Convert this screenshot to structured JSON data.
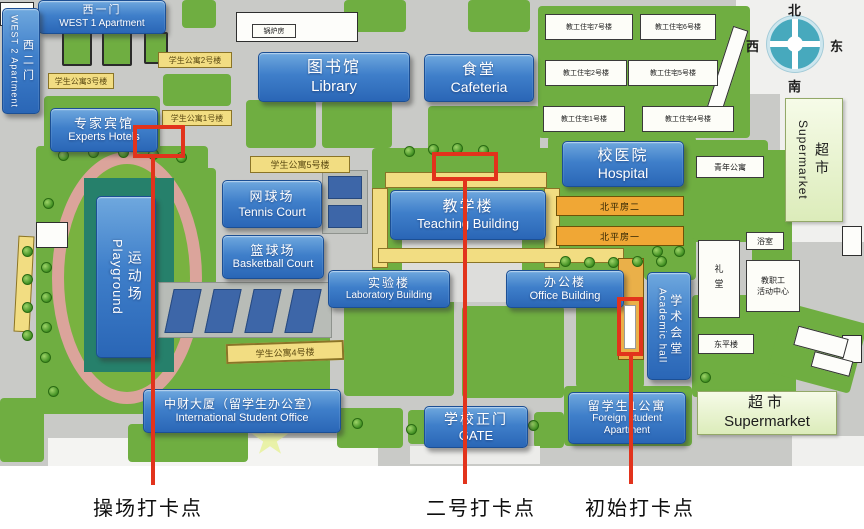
{
  "colors": {
    "map_gray": "#c9cac7",
    "lawn_green": "#6fae41",
    "annotation_red": "#e2331c",
    "label_blue": "#3f7fca",
    "apartment_yellow": "#f2dd82",
    "bungalow_orange": "#f0a735"
  },
  "compass": {
    "north": "北",
    "west": "西",
    "east": "东",
    "south": "南"
  },
  "labels": {
    "west1": {
      "zh": "西一门",
      "en": "WEST 1 Apartment"
    },
    "west2": {
      "zh": "西二门",
      "en": "WEST 2 Apartment"
    },
    "experts": {
      "zh": "专家宾馆",
      "en": "Experts Hotels"
    },
    "library": {
      "zh": "图书馆",
      "en": "Library"
    },
    "cafeteria": {
      "zh": "食堂",
      "en": "Cafeteria"
    },
    "hospital": {
      "zh": "校医院",
      "en": "Hospital"
    },
    "tennis": {
      "zh": "网球场",
      "en": "Tennis Court"
    },
    "basketball": {
      "zh": "篮球场",
      "en": "Basketball Court"
    },
    "teaching": {
      "zh": "教学楼",
      "en": "Teaching Building"
    },
    "laboratory": {
      "zh": "实验楼",
      "en": "Laboratory Building"
    },
    "office": {
      "zh": "办公楼",
      "en": "Office Building"
    },
    "academic": {
      "zh": "学术会堂",
      "en": "Academic hall"
    },
    "playground": {
      "zh": "运动场",
      "en": "Playground"
    },
    "intl_office": {
      "zh": "中财大厦（留学生办公室）",
      "en": "International Student Office"
    },
    "gate": {
      "zh": "学校正门",
      "en": "GATE"
    },
    "foreign_apt": {
      "zh": "留学生1公寓",
      "en1": "Foreign student",
      "en2": "Apartment"
    }
  },
  "small_labels": {
    "stu_apt_1": "学生公寓1号楼",
    "stu_apt_2": "学生公寓2号楼",
    "stu_apt_3": "学生公寓3号楼",
    "stu_apt_4": "学生公寓4号楼",
    "stu_apt_5": "学生公寓5号楼",
    "staff_1": "教工住宅1号楼",
    "staff_2": "教工住宅2号楼",
    "staff_4": "教工住宅4号楼",
    "staff_5": "教工住宅5号楼",
    "staff_6": "教工住宅6号楼",
    "staff_7": "教工住宅7号楼",
    "north_house_2": "北平房二",
    "north_house_1": "北平房一",
    "youth_apt": "青年公寓",
    "bath": "浴室",
    "staff_center_1": "教职工",
    "staff_center_2": "活动中心",
    "auditorium": "礼堂",
    "dongping": "东平楼",
    "boiler": "锅炉房"
  },
  "supermarket": {
    "zh": "超市",
    "en": "Supermarket"
  },
  "checkpoints": {
    "playground": "操场打卡点",
    "no2": "二号打卡点",
    "initial": "初始打卡点"
  }
}
